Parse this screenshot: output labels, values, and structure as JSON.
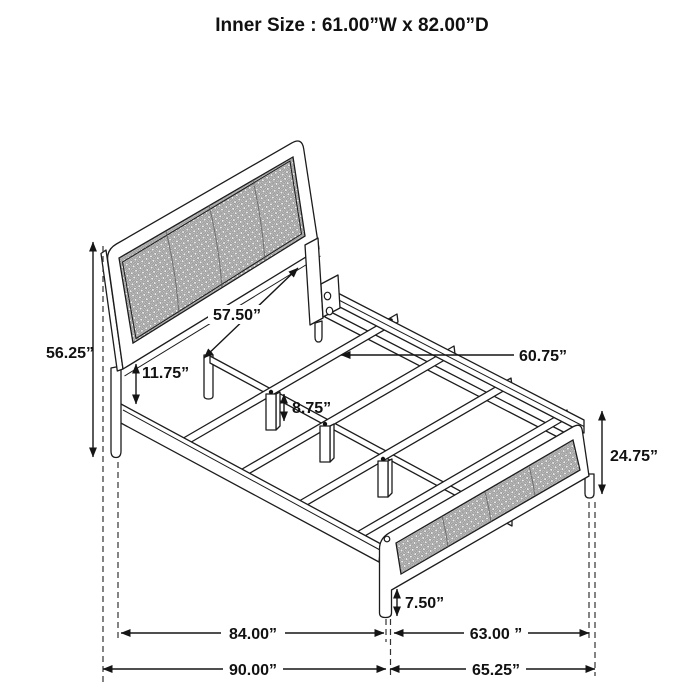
{
  "title": "Inner Size : 61.00”W x 82.00”D",
  "diagram": {
    "product": "bed-frame-dimension-drawing",
    "units": "inches",
    "inner_size": {
      "width": "61.00”W",
      "depth": "82.00”D"
    },
    "labels": {
      "headboard_width": "57.50”",
      "headboard_height": "56.25”",
      "headboard_rail_gap": "11.75”",
      "slat_leg_height": "8.75”",
      "slat_length": "60.75”",
      "footboard_height": "24.75”",
      "footboard_leg_height": "7.50”",
      "inner_length": "84.00”",
      "footboard_span": "63.00 ”",
      "overall_length": "90.00”",
      "overall_width": "65.25”"
    }
  }
}
